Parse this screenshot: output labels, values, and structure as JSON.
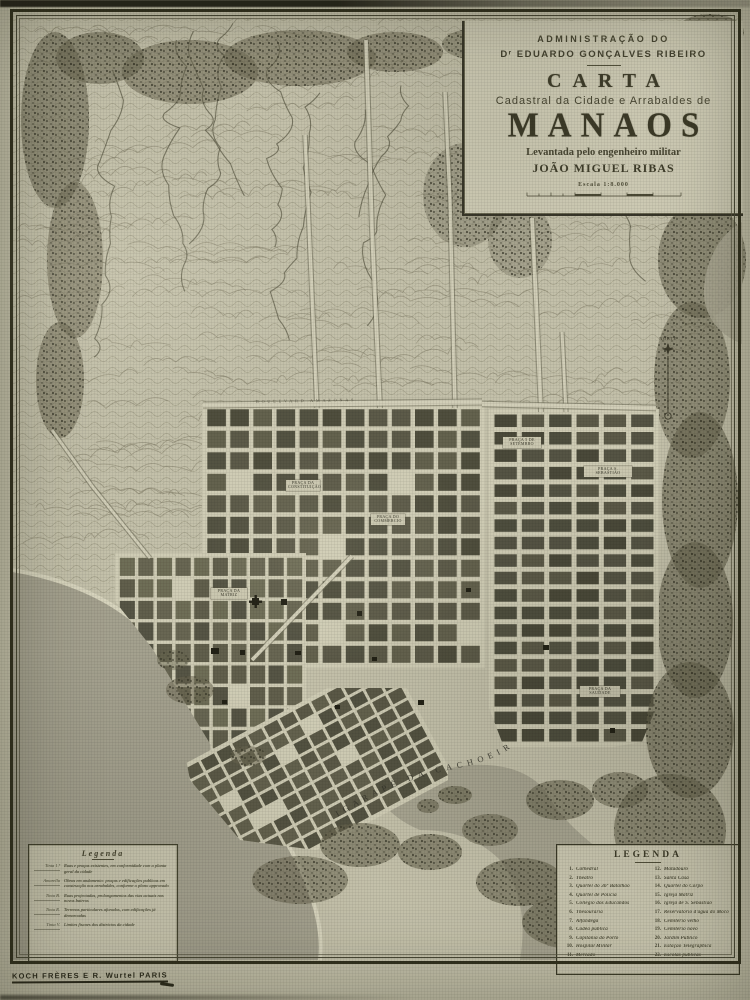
{
  "cartouche": {
    "line1": "ADMINISTRAÇÃO DO",
    "line2": "Dʳ EDUARDO GONÇALVES RIBEIRO",
    "title": "CARTA",
    "subtitle": "Cadastral da Cidade e Arrabaldes de",
    "city": "MANAOS",
    "line3": "Levantada pelo engenheiro militar",
    "author": "JOÃO MIGUEL RIBAS",
    "scale_label": "Escala 1:8.000"
  },
  "legend_left": {
    "title": "Legenda",
    "entries": [
      {
        "key": "Tinta 1.ª",
        "desc": "Ruas e praças existentes, em conformidade com a planta geral da cidade"
      },
      {
        "key": "Amarella",
        "desc": "Obras em andamento: praças e edificações publicas em construcção nos arrabaldes, conforme o plano approvado"
      },
      {
        "key": "Tinta B.",
        "desc": "Ruas projectadas, prolongamentos das vias actuais nos novos bairros"
      },
      {
        "key": "Tinta R.",
        "desc": "Terrenos particulares aforados, com edificações já demarcadas"
      },
      {
        "key": "Tinta V.",
        "desc": "Limites fiscaes dos districtos da cidade"
      }
    ]
  },
  "legend_right": {
    "title": "LEGENDA",
    "items_left": [
      {
        "n": "1.",
        "label": "Cathedral"
      },
      {
        "n": "2.",
        "label": "Theatro"
      },
      {
        "n": "3.",
        "label": "Quartel do 36º Batalhão"
      },
      {
        "n": "4.",
        "label": "Quartel de Policia"
      },
      {
        "n": "5.",
        "label": "Collegio dos Educandos"
      },
      {
        "n": "6.",
        "label": "Thesouraria"
      },
      {
        "n": "7.",
        "label": "Alfandega"
      },
      {
        "n": "8.",
        "label": "Cadêa publica"
      },
      {
        "n": "9.",
        "label": "Capitania do Porto"
      },
      {
        "n": "10.",
        "label": "Hospital Militar"
      },
      {
        "n": "11.",
        "label": "Mercado"
      }
    ],
    "items_right": [
      {
        "n": "12.",
        "label": "Matadouro"
      },
      {
        "n": "13.",
        "label": "Santa Casa"
      },
      {
        "n": "14.",
        "label": "Quartel do Corpo"
      },
      {
        "n": "15.",
        "label": "Igreja Matriz"
      },
      {
        "n": "16.",
        "label": "Igreja de S. Sebastião"
      },
      {
        "n": "17.",
        "label": "Reservatorio d'agua do Mocó"
      },
      {
        "n": "18.",
        "label": "Cemiterio velho"
      },
      {
        "n": "19.",
        "label": "Cemiterio novo"
      },
      {
        "n": "20.",
        "label": "Jardim Publico"
      },
      {
        "n": "21.",
        "label": "Estação Telegraphica"
      },
      {
        "n": "22.",
        "label": "Escolas publicas"
      }
    ]
  },
  "map_labels": {
    "river": "IGARAPÉ  DA  CACHOEIRA",
    "boulevard": "BOULEVARD AMAZONAS",
    "north": "NORTE",
    "plazas": [
      {
        "name": "PRAÇA 5 DE SETEMBRO"
      },
      {
        "name": "PRAÇA DA CONSTITUIÇÃO"
      },
      {
        "name": "PRAÇA DO COMMERCIO"
      },
      {
        "name": "PRAÇA DA MATRIZ"
      },
      {
        "name": "PRAÇA S. SEBASTIÃO"
      },
      {
        "name": "PRAÇA DA SAUDADE"
      }
    ]
  },
  "imprint": "KOCH FRÈRES  E  R. Wurtel  PARIS",
  "colors": {
    "paper": "#c9c6b0",
    "ink": "#3e3c2c",
    "water": "#a8a593",
    "block": "#5e5c4b",
    "forest": "#6b6852",
    "street": "#d4d1ba"
  }
}
